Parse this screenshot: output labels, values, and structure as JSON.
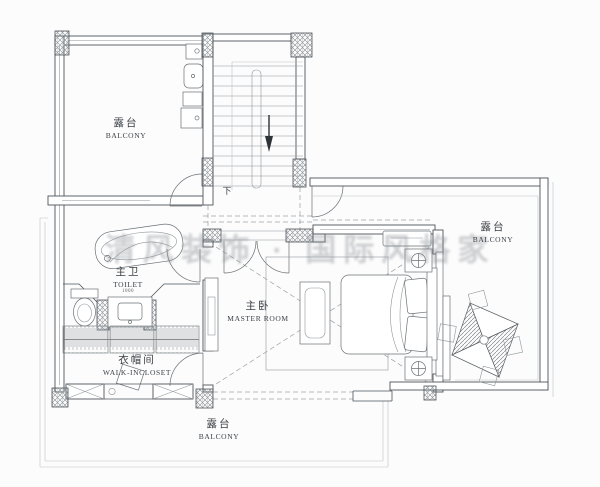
{
  "labels": {
    "balcony_top_left": {
      "zh": "露台",
      "en": "BALCONY"
    },
    "stairs": {
      "down": "下"
    },
    "toilet": {
      "zh": "主卫",
      "en": "TOILET",
      "vanity_dim": "1000"
    },
    "closet": {
      "zh": "衣帽间",
      "en": "WALK-INCLOSET"
    },
    "master": {
      "zh": "主卧",
      "en": "MASTER ROOM"
    },
    "balcony_right": {
      "zh": "露台",
      "en": "BALCONY"
    },
    "balcony_bottom": {
      "zh": "露台",
      "en": "BALCONY"
    }
  },
  "watermark": "清风装饰 · 国际风格家",
  "colors": {
    "wall_line": "#4e545a",
    "light_line": "#8f969b",
    "watermark_gray": "#8a9096",
    "background": "#fcfcfc"
  }
}
